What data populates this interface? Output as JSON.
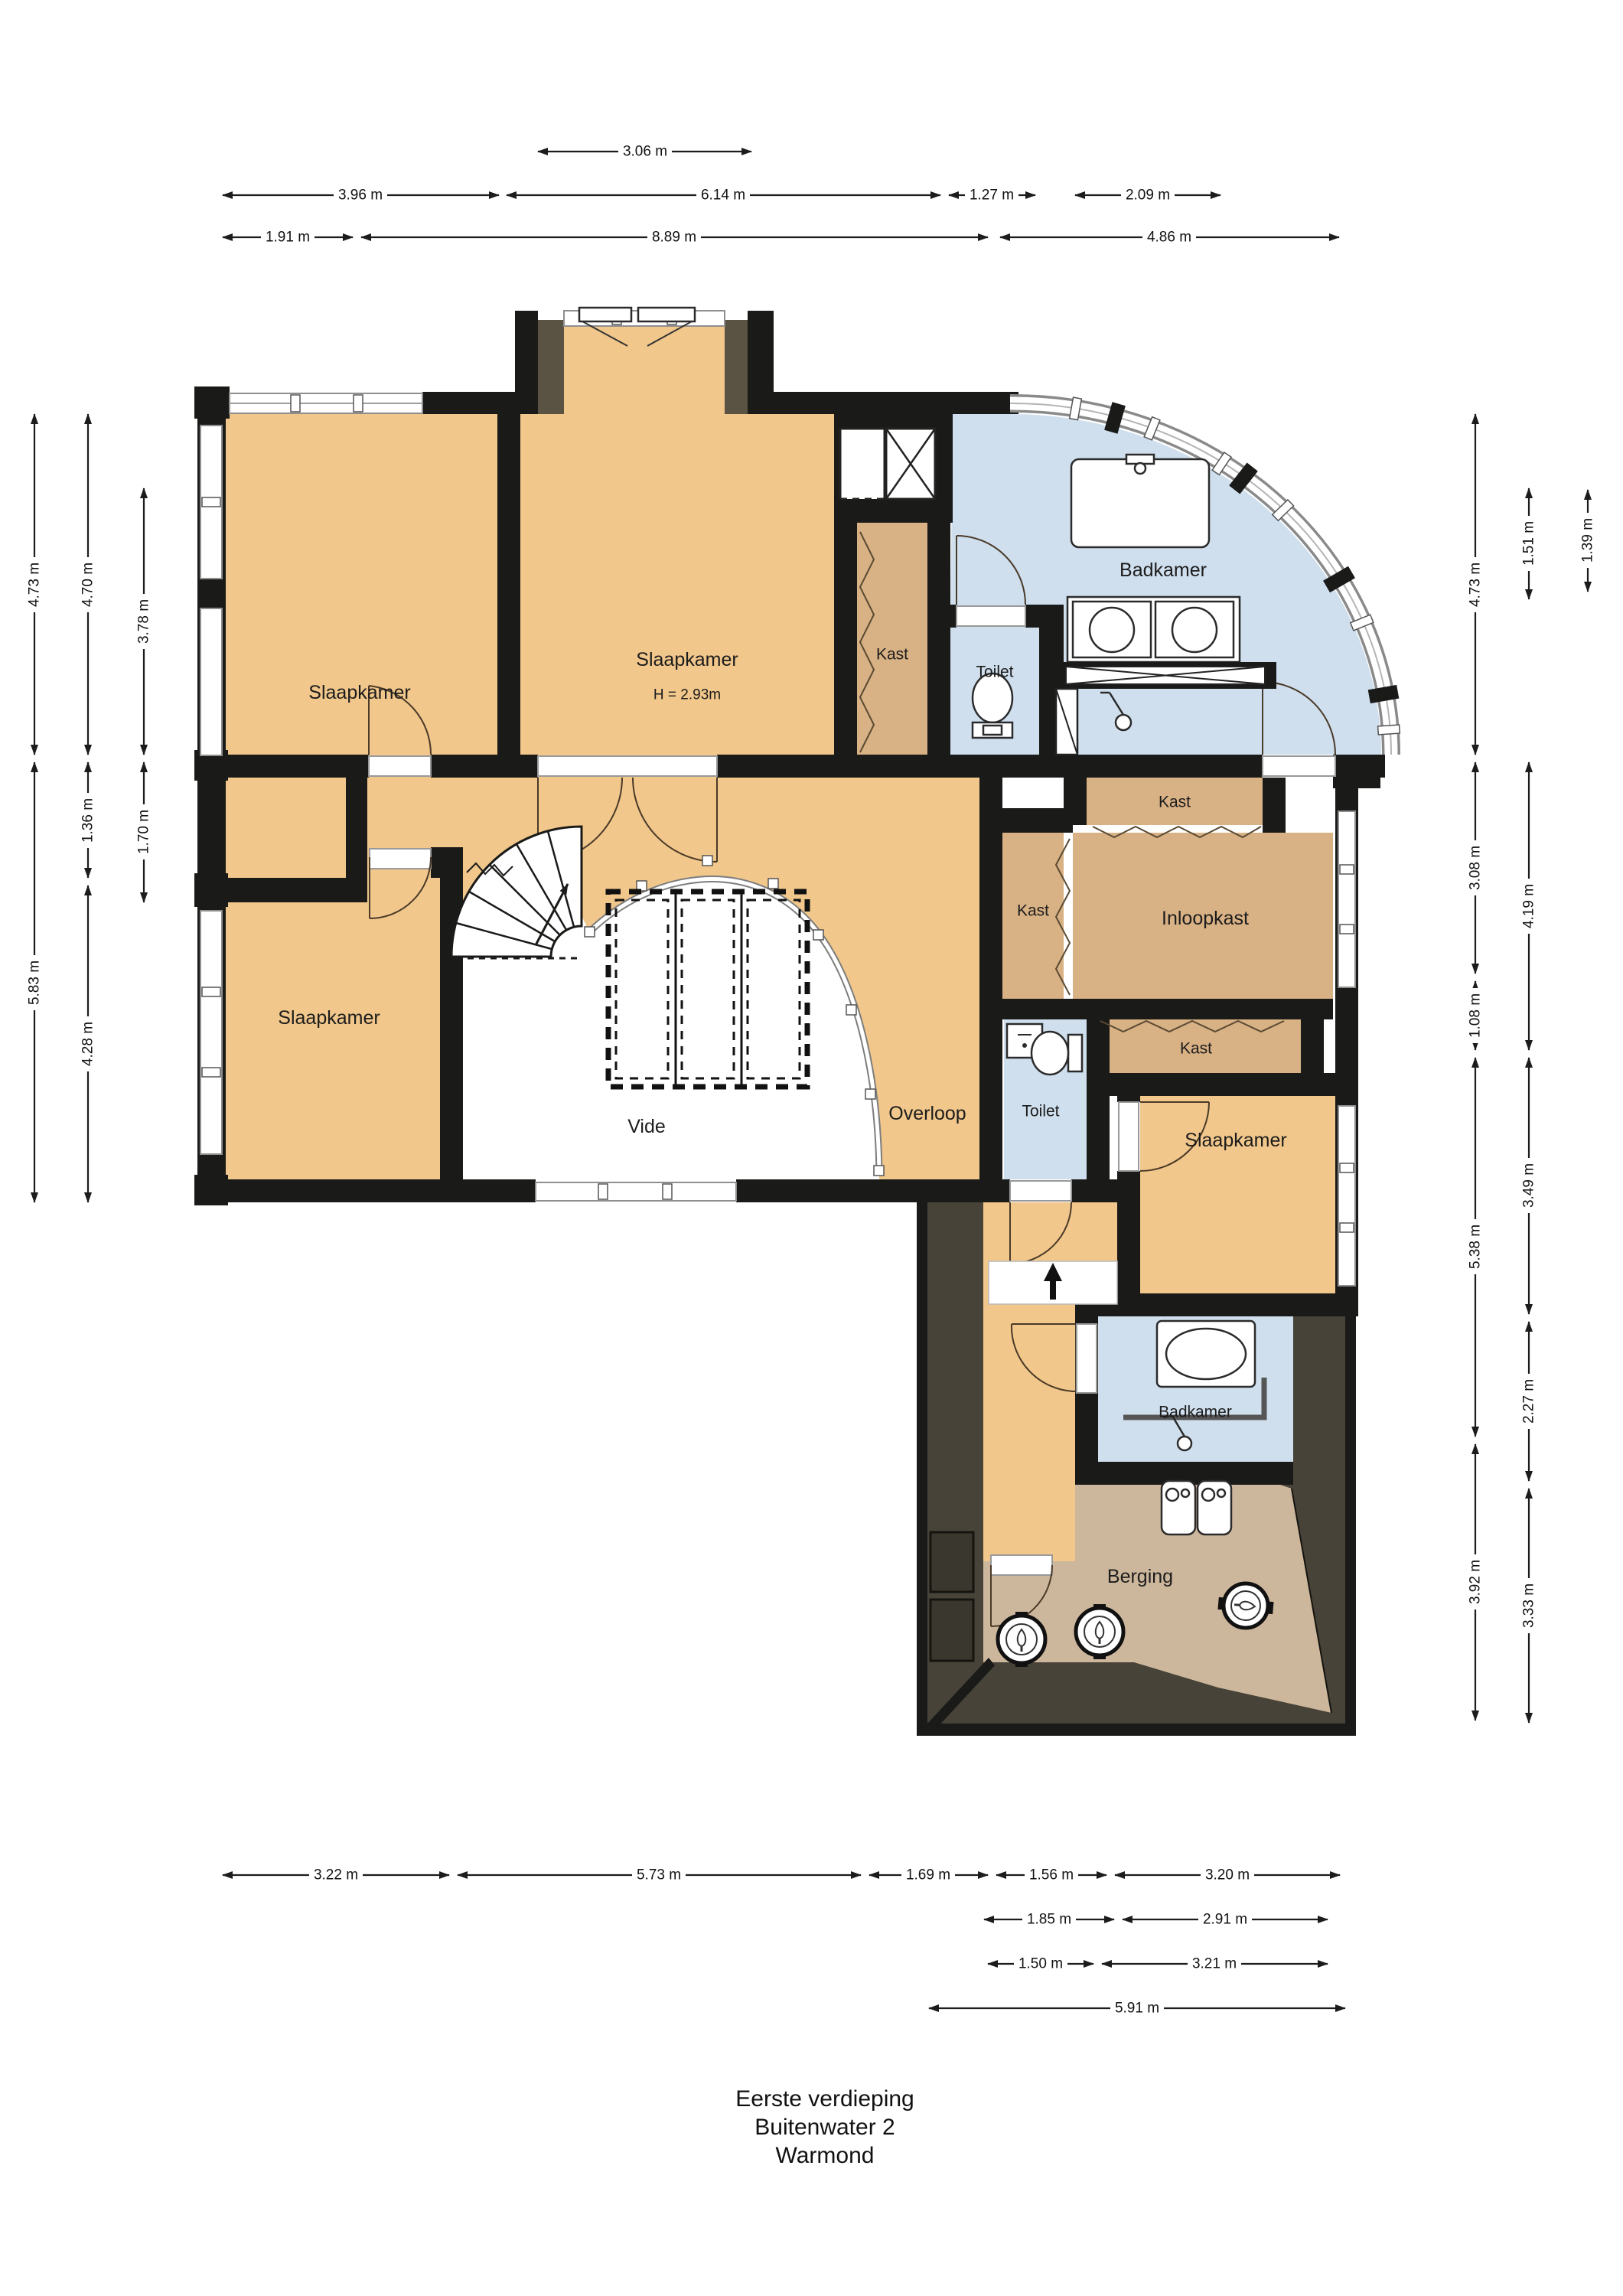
{
  "title": [
    "Eerste verdieping",
    "Buitenwater 2",
    "Warmond"
  ],
  "rooms": {
    "slaapkamer_nw": "Slaapkamer",
    "slaapkamer_n": "Slaapkamer",
    "slaapkamer_n_h": "H = 2.93m",
    "badkamer_n": "Badkamer",
    "kast_wand": "Kast",
    "toilet_n": "Toilet",
    "kast_n": "Kast",
    "kast_w": "Kast",
    "inloopkast": "Inloopkast",
    "toilet_s": "Toilet",
    "kast_s": "Kast",
    "slaapkamer_sw": "Slaapkamer",
    "vide": "Vide",
    "overloop": "Overloop",
    "slaapkamer_se": "Slaapkamer",
    "badkamer_s": "Badkamer",
    "berging": "Berging"
  },
  "dims": {
    "top_row1": [
      "3.06 m"
    ],
    "top_row2": [
      "3.96 m",
      "6.14 m",
      "1.27 m",
      "2.09 m"
    ],
    "top_row3": [
      "1.91 m",
      "8.89 m",
      "4.86 m"
    ],
    "left_col1": [
      "4.73 m",
      "5.83 m"
    ],
    "left_col2": [
      "4.70 m",
      "1.36 m",
      "4.28 m"
    ],
    "left_col3": [
      "3.78 m",
      "1.70 m"
    ],
    "right_col1": [
      "4.73 m",
      "3.08 m",
      "1.08 m",
      "5.38 m",
      "3.92 m"
    ],
    "right_col2": [
      "1.51 m",
      "4.19 m",
      "3.49 m",
      "2.27 m",
      "3.33 m"
    ],
    "right_col3": [
      "1.39 m"
    ],
    "bottom_row1": [
      "3.22 m",
      "5.73 m",
      "1.69 m",
      "1.56 m",
      "3.20 m"
    ],
    "bottom_row2": [
      "1.85 m",
      "2.91 m"
    ],
    "bottom_row3": [
      "1.50 m",
      "3.21 m"
    ],
    "bottom_row4": [
      "5.91 m"
    ]
  },
  "colors": {
    "floor": "#f1c78b",
    "closet": "#d8b184",
    "bath": "#cfdfee",
    "storage": "#cdb79c",
    "wall": "#1a1a18",
    "attic": "#474338",
    "bay_lining": "#5a5243"
  }
}
